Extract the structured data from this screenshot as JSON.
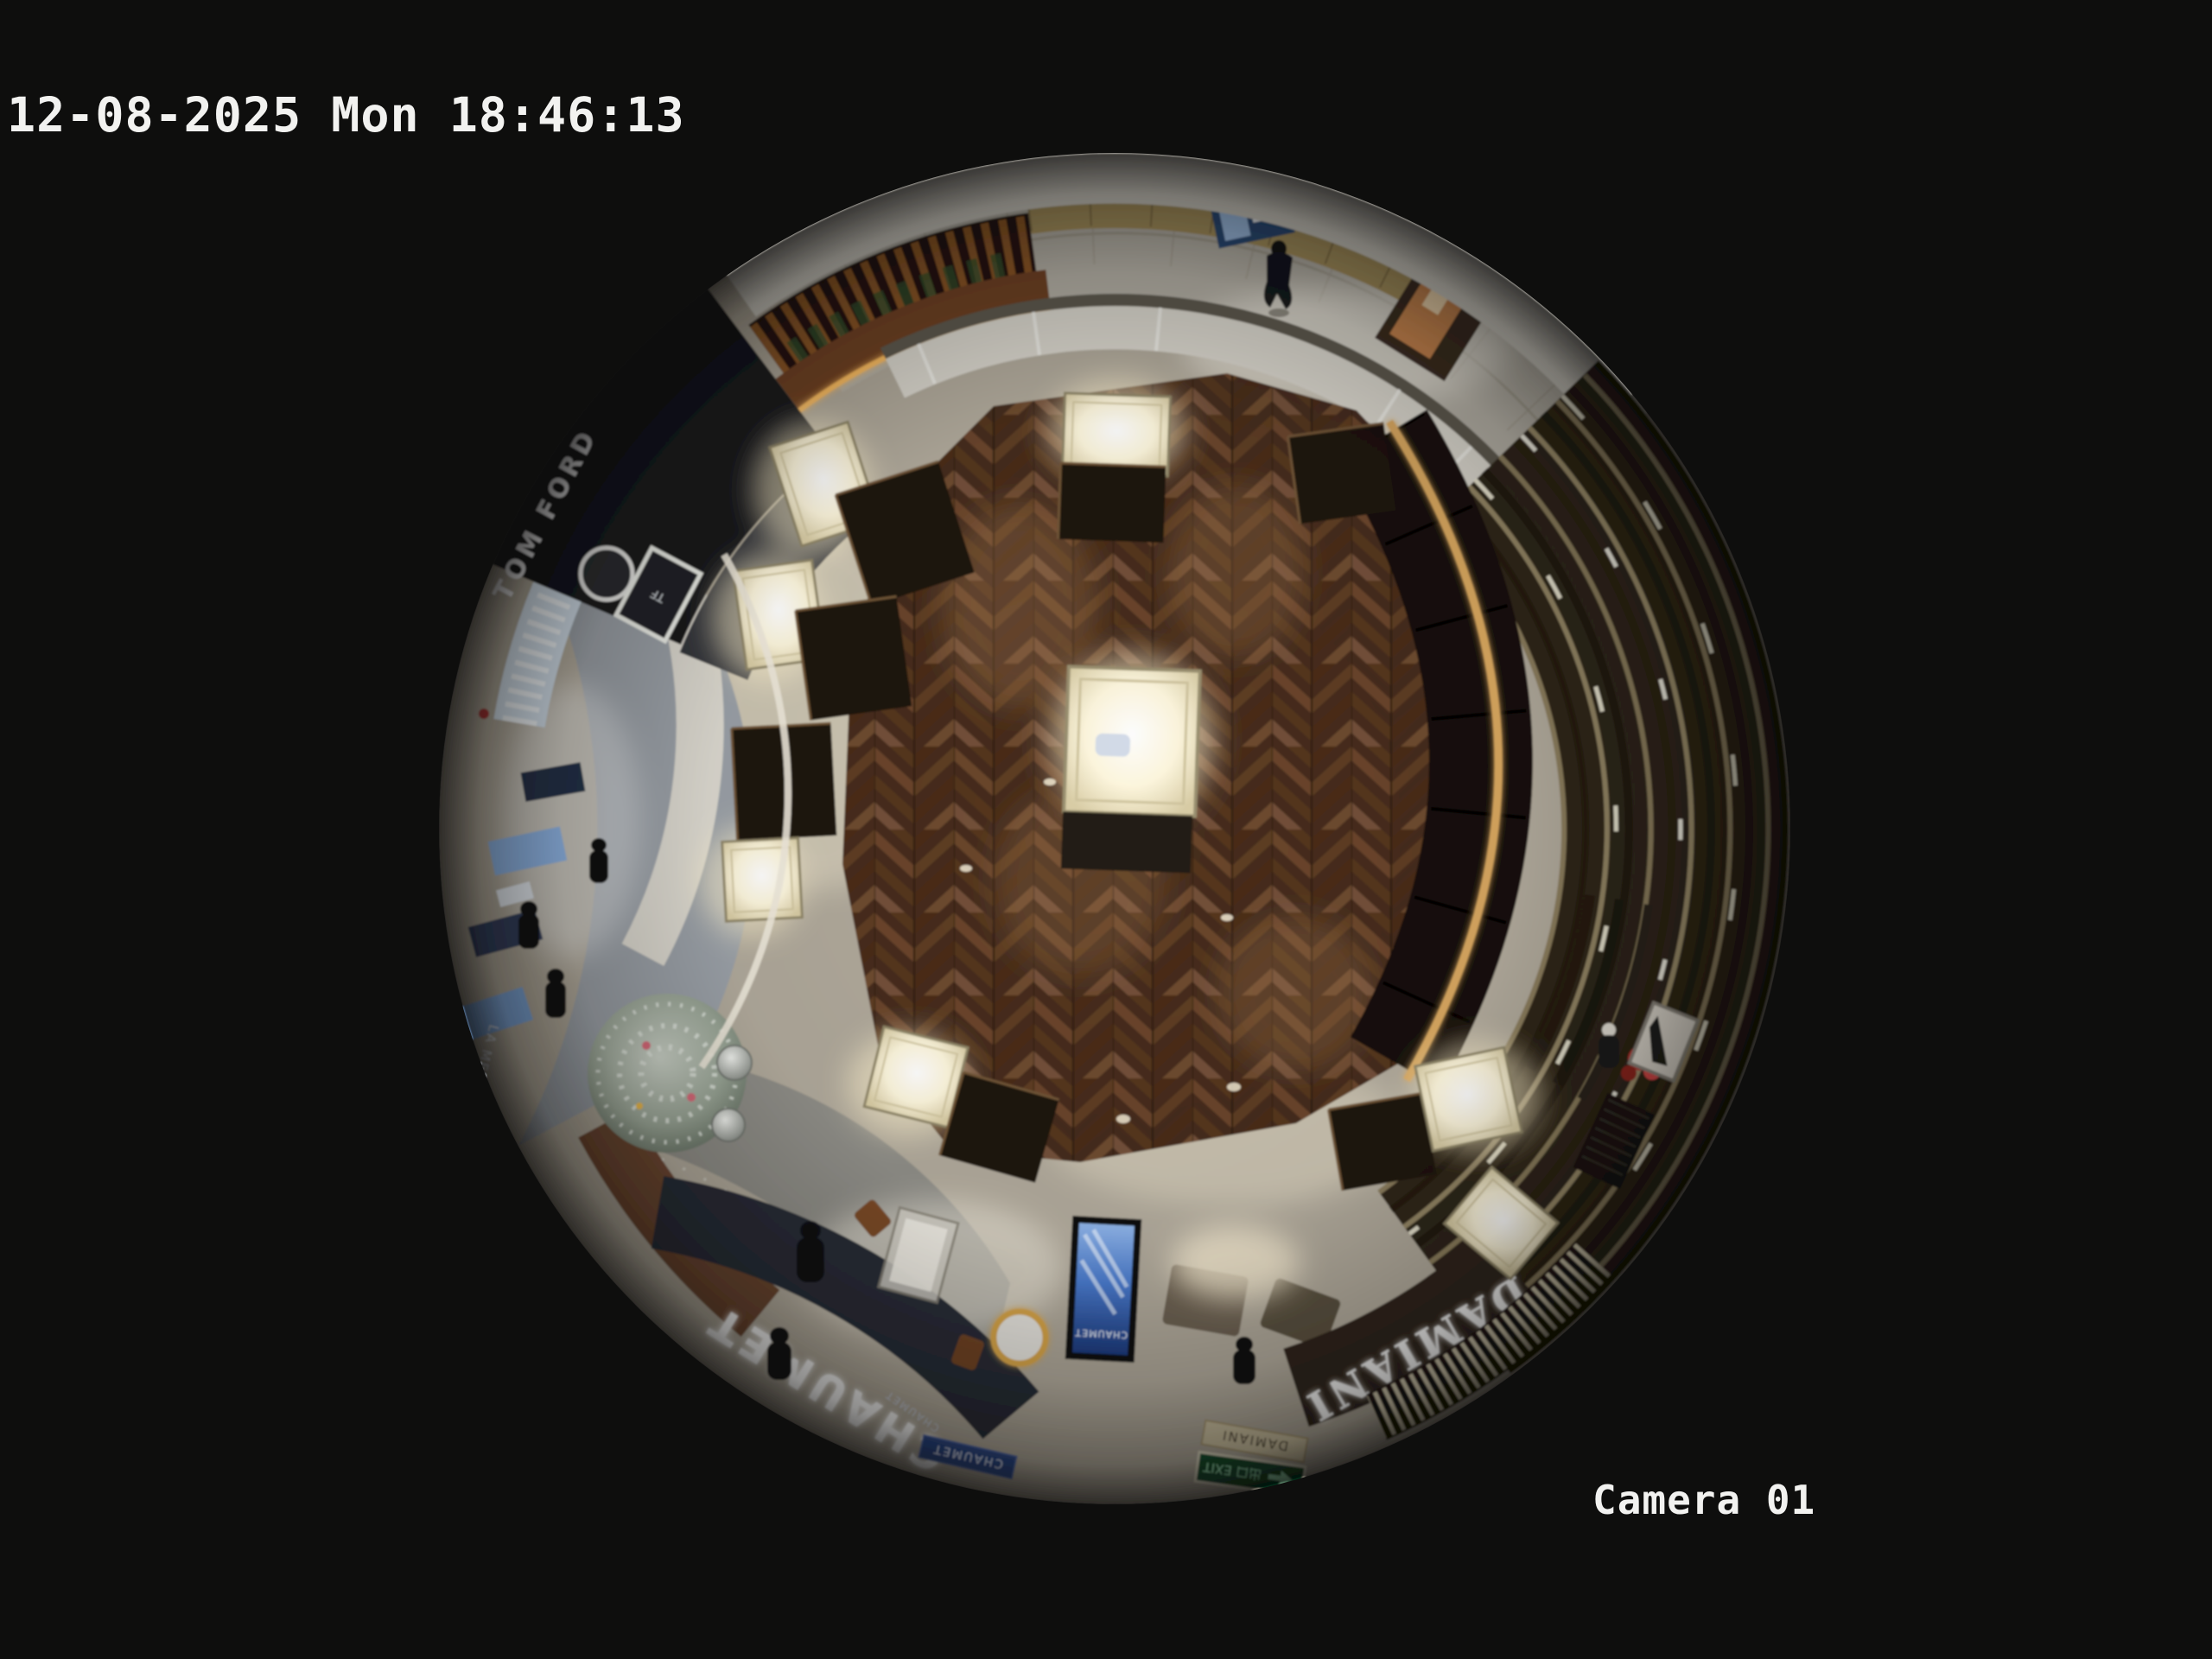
{
  "osd": {
    "timestamp": "12-08-2025 Mon 18:46:13",
    "camera_label": "Camera 01"
  },
  "scene": {
    "signs": {
      "chaumet_fascia": "CHAUMET",
      "chaumet_sub": "CHAUMET",
      "chaumet_plaque": "CHAUMET",
      "chaumet_screen": "CHAUMET",
      "damiani_fascia": "DAMIANI",
      "damiani_plaque": "DAMIANI",
      "tom_ford": "TOM FORD",
      "tf_monogram": "TF",
      "la_mer": "LA MER",
      "exit_sign": "出口 EXIT"
    },
    "colors": {
      "background": "#0e0e0d",
      "stone_floor": "#b0a99b",
      "corridor_marble": "#b4b0a6",
      "wood_floor": "#54382a",
      "chaumet_navy": "#262b36",
      "damiani_brown": "#2e241b",
      "counter_gold": "#d8a75e",
      "screen_blue": "#3c6fc4",
      "exit_green": "#0f4f2e",
      "tree_silver": "#aeb8ab",
      "kiosk_wood": "#8a5526",
      "tomford_black": "#16171b",
      "osd_text": "#f2f2f0"
    }
  }
}
